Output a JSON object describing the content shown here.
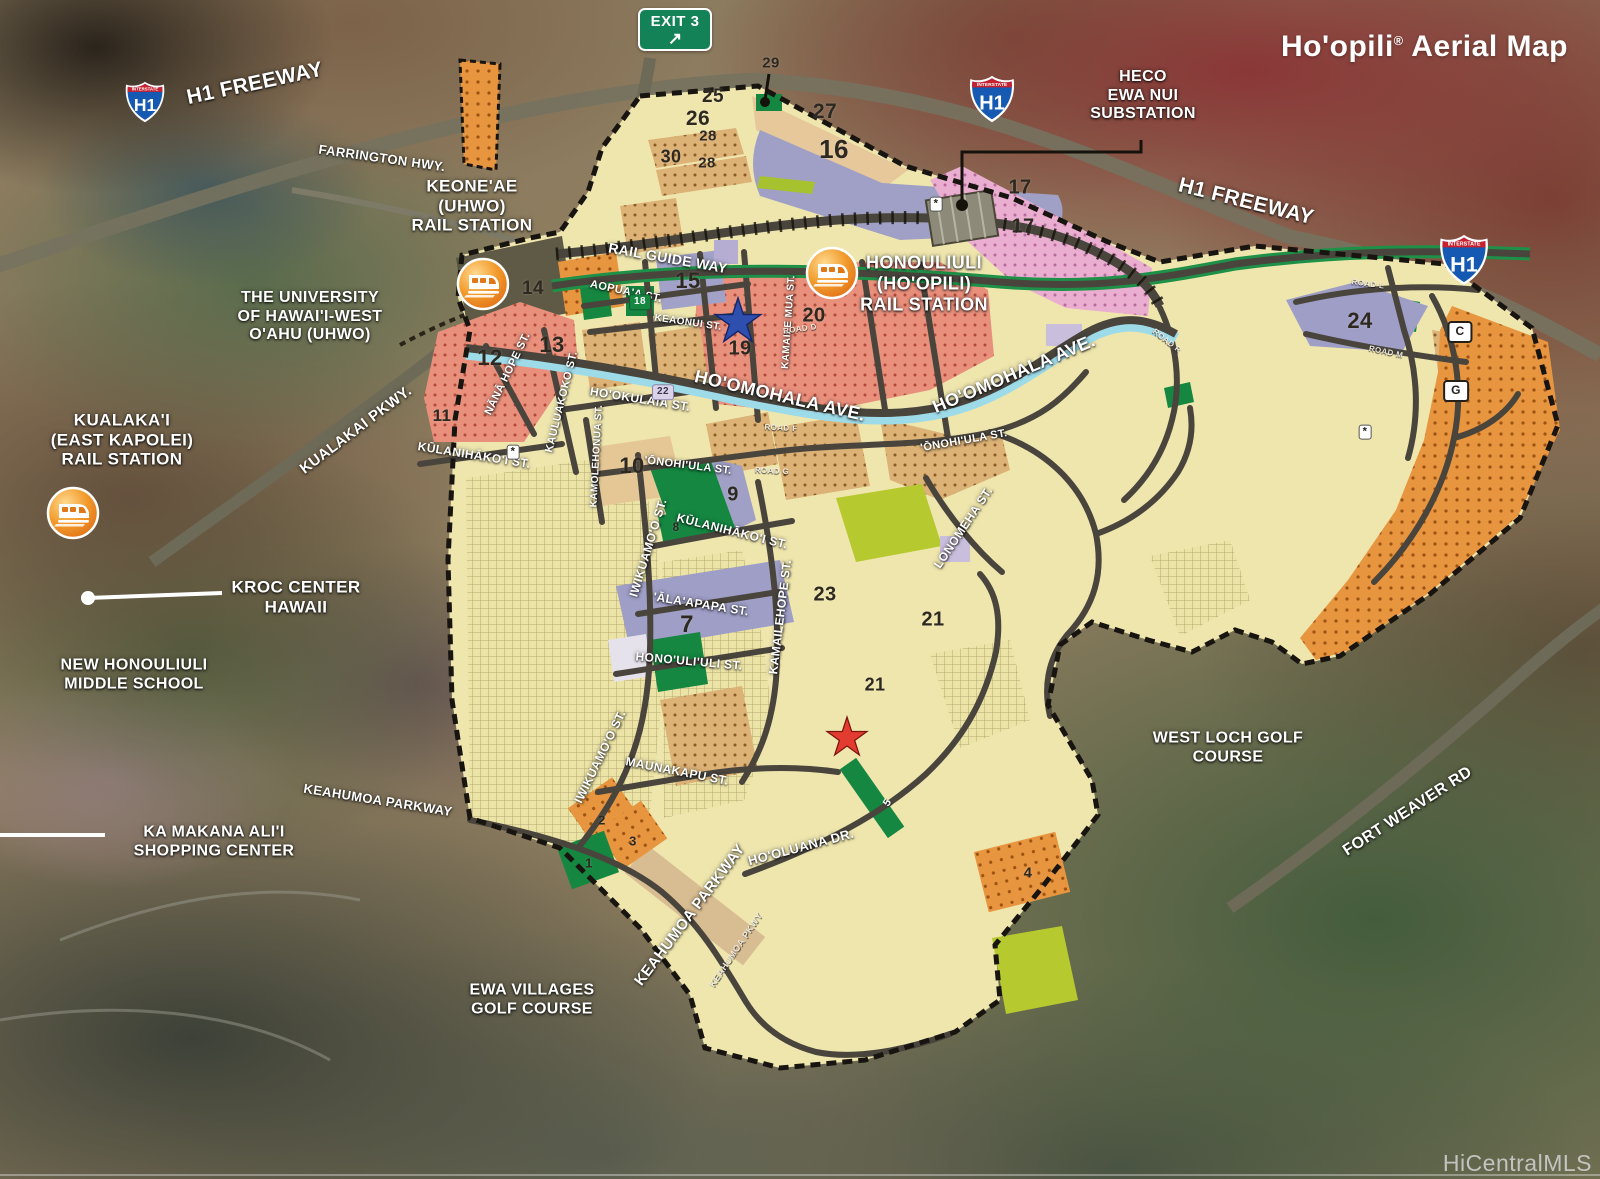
{
  "title": {
    "name": "Ho'opili",
    "reg": "®",
    "rest": " Aerial Map"
  },
  "watermark": "HiCentralMLS",
  "exit_sign": {
    "text": "EXIT 3",
    "arrow": "↗"
  },
  "h1_shield": {
    "top": "INTERSTATE",
    "label": "H1"
  },
  "palette": {
    "plan_base": "#efe6ae",
    "salmon": "#e9907d",
    "salmon_dot": "#b14a38",
    "pink": "#e9aed0",
    "pink_dot": "#b86a9c",
    "orange": "#e8953f",
    "orange_dot": "#9c5212",
    "tan": "#e4c795",
    "tan_dot_bg": "#dcb277",
    "tan_dot": "#8a5c28",
    "lavender": "#9e9ec6",
    "green": "#158741",
    "lime": "#b6c92f",
    "grid_bg": "#ece3a6",
    "grid_line": "#b3a871",
    "road": "#49453d",
    "highway": "#6e6a58",
    "canal": "#9edbe9",
    "rail_green": "#1f9048",
    "boundary": "#181410",
    "star_blue": "#2f4fae",
    "star_red": "#e23b30",
    "label_white": "#ffffff",
    "number_dark": "#2d2920",
    "watermark_gray": "#c4c4c4",
    "exit_green": "#148257",
    "shield_blue": "#1559b3",
    "shield_red": "#c8202f"
  },
  "labels": [
    {
      "t": "H1 FREEWAY",
      "x": 255,
      "y": 84,
      "r": -12,
      "s": 21,
      "c": "place"
    },
    {
      "t": "FARRINGTON HWY.",
      "x": 382,
      "y": 158,
      "r": 8,
      "s": 13,
      "c": "place"
    },
    {
      "t": "H1 FREEWAY",
      "x": 1246,
      "y": 202,
      "r": 14,
      "s": 21,
      "c": "place"
    },
    {
      "t": "HECO\nEWA NUI\nSUBSTATION",
      "x": 1143,
      "y": 96,
      "r": 0,
      "s": 16,
      "c": "place"
    },
    {
      "t": "KEONE'AE\n(UHWO)\nRAIL STATION",
      "x": 472,
      "y": 206,
      "r": 0,
      "s": 17,
      "c": "place"
    },
    {
      "t": "THE UNIVERSITY\nOF HAWAI'I-WEST\nO'AHU (UHWO)",
      "x": 310,
      "y": 317,
      "r": 0,
      "s": 16,
      "c": "place"
    },
    {
      "t": "KUALAKA'I\n(EAST KAPOLEI)\nRAIL STATION",
      "x": 122,
      "y": 440,
      "r": 0,
      "s": 17,
      "c": "place"
    },
    {
      "t": "KUALAKAI PKWY.",
      "x": 356,
      "y": 430,
      "r": -37,
      "s": 15,
      "c": "place"
    },
    {
      "t": "KROC CENTER\nHAWAII",
      "x": 296,
      "y": 597,
      "r": 0,
      "s": 17,
      "c": "place"
    },
    {
      "t": "NEW HONOULIULI\nMIDDLE SCHOOL",
      "x": 134,
      "y": 675,
      "r": 0,
      "s": 16,
      "c": "place"
    },
    {
      "t": "KA MAKANA ALI'I\nSHOPPING CENTER",
      "x": 214,
      "y": 842,
      "r": 0,
      "s": 16,
      "c": "place"
    },
    {
      "t": "EWA VILLAGES\nGOLF COURSE",
      "x": 532,
      "y": 1000,
      "r": 0,
      "s": 16,
      "c": "place"
    },
    {
      "t": "WEST LOCH GOLF\nCOURSE",
      "x": 1228,
      "y": 748,
      "r": 0,
      "s": 16,
      "c": "place"
    },
    {
      "t": "FORT WEAVER RD",
      "x": 1408,
      "y": 812,
      "r": -33,
      "s": 16,
      "c": "place"
    },
    {
      "t": "HONOULIULI\n(HO'OPILI)\nRAIL STATION",
      "x": 924,
      "y": 284,
      "r": 0,
      "s": 18,
      "c": "place"
    },
    {
      "t": "KEAHUMOA PARKWAY",
      "x": 378,
      "y": 800,
      "r": 9,
      "s": 13,
      "c": "place"
    },
    {
      "t": "KEAHUMOA PARKWAY",
      "x": 690,
      "y": 915,
      "r": -53,
      "s": 15,
      "c": "place"
    },
    {
      "t": "KEAHUMOA PKWY",
      "x": 736,
      "y": 950,
      "r": -56,
      "s": 9,
      "c": "roadsm"
    },
    {
      "t": "RAIL GUIDE WAY",
      "x": 668,
      "y": 258,
      "r": 10,
      "s": 14,
      "c": "place"
    },
    {
      "t": "HO'OMOHALA AVE.",
      "x": 780,
      "y": 396,
      "r": 13,
      "s": 18,
      "c": "place"
    },
    {
      "t": "HO'OMOHALA AVE.",
      "x": 1014,
      "y": 374,
      "r": -23,
      "s": 18,
      "c": "place"
    },
    {
      "t": "AOPUA'A ST.",
      "x": 626,
      "y": 292,
      "r": 12,
      "s": 11,
      "c": "street"
    },
    {
      "t": "KEAONUI ST.",
      "x": 688,
      "y": 323,
      "r": 8,
      "s": 10,
      "c": "street"
    },
    {
      "t": "KAMAILE MUA ST.",
      "x": 789,
      "y": 322,
      "r": -86,
      "s": 10,
      "c": "street"
    },
    {
      "t": "NĀNĀ HOPE ST.",
      "x": 508,
      "y": 374,
      "r": -64,
      "s": 11,
      "c": "street"
    },
    {
      "t": "KAULUAKOKO ST.",
      "x": 562,
      "y": 402,
      "r": -76,
      "s": 11,
      "c": "street"
    },
    {
      "t": "KAMOLEHONUA ST.",
      "x": 597,
      "y": 456,
      "r": -87,
      "s": 10,
      "c": "street"
    },
    {
      "t": "HO'OKULAIA ST.",
      "x": 640,
      "y": 400,
      "r": 9,
      "s": 12,
      "c": "street"
    },
    {
      "t": "KŪLANIHĀKO'I ST.",
      "x": 474,
      "y": 456,
      "r": 9,
      "s": 12,
      "c": "street"
    },
    {
      "t": "KŪLANIHĀKO'I ST.",
      "x": 732,
      "y": 532,
      "r": 14,
      "s": 12,
      "c": "street"
    },
    {
      "t": "'ŌNOHI'ULA ST.",
      "x": 688,
      "y": 466,
      "r": 7,
      "s": 11,
      "c": "street"
    },
    {
      "t": "'ŌNOHI'ULA ST.",
      "x": 964,
      "y": 441,
      "r": -10,
      "s": 11,
      "c": "street"
    },
    {
      "t": "IWIKUAMO'O ST.",
      "x": 649,
      "y": 548,
      "r": -73,
      "s": 12,
      "c": "street"
    },
    {
      "t": "IWIKUAMO'O ST.",
      "x": 601,
      "y": 757,
      "r": -64,
      "s": 12,
      "c": "street"
    },
    {
      "t": "'ĀLA'APAPA ST.",
      "x": 701,
      "y": 605,
      "r": 9,
      "s": 12,
      "c": "street"
    },
    {
      "t": "HONO'ULI'ULI ST.",
      "x": 689,
      "y": 662,
      "r": 5,
      "s": 12,
      "c": "street"
    },
    {
      "t": "KAMAILEHOPE ST.",
      "x": 781,
      "y": 617,
      "r": -83,
      "s": 12,
      "c": "street"
    },
    {
      "t": "LONOMEHA ST.",
      "x": 964,
      "y": 528,
      "r": -56,
      "s": 12,
      "c": "street"
    },
    {
      "t": "MAUNAKAPU ST.",
      "x": 677,
      "y": 772,
      "r": 11,
      "s": 12,
      "c": "street"
    },
    {
      "t": "HO'OLUANA DR.",
      "x": 801,
      "y": 847,
      "r": -15,
      "s": 13,
      "c": "street"
    },
    {
      "t": "ROAD D",
      "x": 800,
      "y": 329,
      "r": -8,
      "s": 8,
      "c": "roadsm"
    },
    {
      "t": "ROAD F",
      "x": 781,
      "y": 428,
      "r": 3,
      "s": 8,
      "c": "roadsm"
    },
    {
      "t": "ROAD G",
      "x": 772,
      "y": 471,
      "r": 3,
      "s": 8,
      "c": "roadsm"
    },
    {
      "t": "ROAD L",
      "x": 1368,
      "y": 284,
      "r": 8,
      "s": 8,
      "c": "roadsm"
    },
    {
      "t": "ROAD M",
      "x": 1386,
      "y": 352,
      "r": 12,
      "s": 8,
      "c": "roadsm"
    },
    {
      "t": "ROAD R",
      "x": 1167,
      "y": 341,
      "r": 38,
      "s": 8,
      "c": "roadsm"
    },
    {
      "t": "25",
      "x": 713,
      "y": 97,
      "s": 19,
      "c": "parcel"
    },
    {
      "t": "26",
      "x": 698,
      "y": 119,
      "s": 21,
      "c": "parcel"
    },
    {
      "t": "28",
      "x": 708,
      "y": 136,
      "s": 15,
      "c": "parcel"
    },
    {
      "t": "30",
      "x": 671,
      "y": 157,
      "s": 18,
      "c": "parcel"
    },
    {
      "t": "28",
      "x": 707,
      "y": 163,
      "s": 15,
      "c": "parcel"
    },
    {
      "t": "27",
      "x": 825,
      "y": 112,
      "s": 21,
      "c": "parcel"
    },
    {
      "t": "16",
      "x": 834,
      "y": 149,
      "s": 26,
      "c": "parcel"
    },
    {
      "t": "29",
      "x": 771,
      "y": 63,
      "s": 15,
      "c": "parcel"
    },
    {
      "t": "17",
      "x": 1020,
      "y": 188,
      "s": 20,
      "c": "parcel"
    },
    {
      "t": "17",
      "x": 1023,
      "y": 227,
      "s": 20,
      "c": "parcel"
    },
    {
      "t": "15",
      "x": 688,
      "y": 281,
      "s": 22,
      "c": "parcel"
    },
    {
      "t": "14",
      "x": 533,
      "y": 289,
      "s": 19,
      "c": "parcel"
    },
    {
      "t": "12",
      "x": 490,
      "y": 358,
      "s": 22,
      "c": "parcel"
    },
    {
      "t": "13",
      "x": 552,
      "y": 345,
      "s": 22,
      "c": "parcel"
    },
    {
      "t": "11",
      "x": 442,
      "y": 416,
      "s": 17,
      "c": "parcel"
    },
    {
      "t": "19",
      "x": 740,
      "y": 349,
      "s": 20,
      "c": "parcel"
    },
    {
      "t": "20",
      "x": 814,
      "y": 316,
      "s": 20,
      "c": "parcel"
    },
    {
      "t": "10",
      "x": 632,
      "y": 466,
      "s": 22,
      "c": "parcel"
    },
    {
      "t": "9",
      "x": 733,
      "y": 495,
      "s": 20,
      "c": "parcel"
    },
    {
      "t": "8",
      "x": 676,
      "y": 528,
      "s": 12,
      "c": "parcel"
    },
    {
      "t": "7",
      "x": 687,
      "y": 625,
      "s": 24,
      "c": "parcel"
    },
    {
      "t": "23",
      "x": 825,
      "y": 595,
      "s": 20,
      "c": "parcel"
    },
    {
      "t": "21",
      "x": 933,
      "y": 620,
      "s": 20,
      "c": "parcel"
    },
    {
      "t": "21",
      "x": 875,
      "y": 685,
      "s": 18,
      "c": "parcel"
    },
    {
      "t": "24",
      "x": 1360,
      "y": 321,
      "s": 22,
      "c": "parcel"
    },
    {
      "t": "2",
      "x": 602,
      "y": 820,
      "s": 13,
      "c": "parcel"
    },
    {
      "t": "3",
      "x": 633,
      "y": 841,
      "s": 13,
      "c": "parcel"
    },
    {
      "t": "1",
      "x": 589,
      "y": 863,
      "s": 13,
      "c": "parcel"
    },
    {
      "t": "4",
      "x": 1028,
      "y": 873,
      "s": 15,
      "c": "parcel"
    },
    {
      "t": "18",
      "x": 640,
      "y": 302,
      "s": 10,
      "c": "badge-g"
    },
    {
      "t": "22",
      "x": 663,
      "y": 392,
      "s": 10,
      "c": "badge-l"
    },
    {
      "t": "C",
      "x": 1460,
      "y": 332,
      "s": 12,
      "c": "badge-w"
    },
    {
      "t": "G",
      "x": 1456,
      "y": 391,
      "s": 12,
      "c": "badge-w"
    },
    {
      "t": "5",
      "x": 888,
      "y": 803,
      "r": -55,
      "s": 11,
      "c": "white-num"
    },
    {
      "t": "*",
      "x": 513,
      "y": 452,
      "s": 11,
      "c": "badge-a"
    },
    {
      "t": "*",
      "x": 936,
      "y": 204,
      "s": 11,
      "c": "badge-a"
    },
    {
      "t": "*",
      "x": 1365,
      "y": 432,
      "s": 11,
      "c": "badge-a"
    }
  ]
}
